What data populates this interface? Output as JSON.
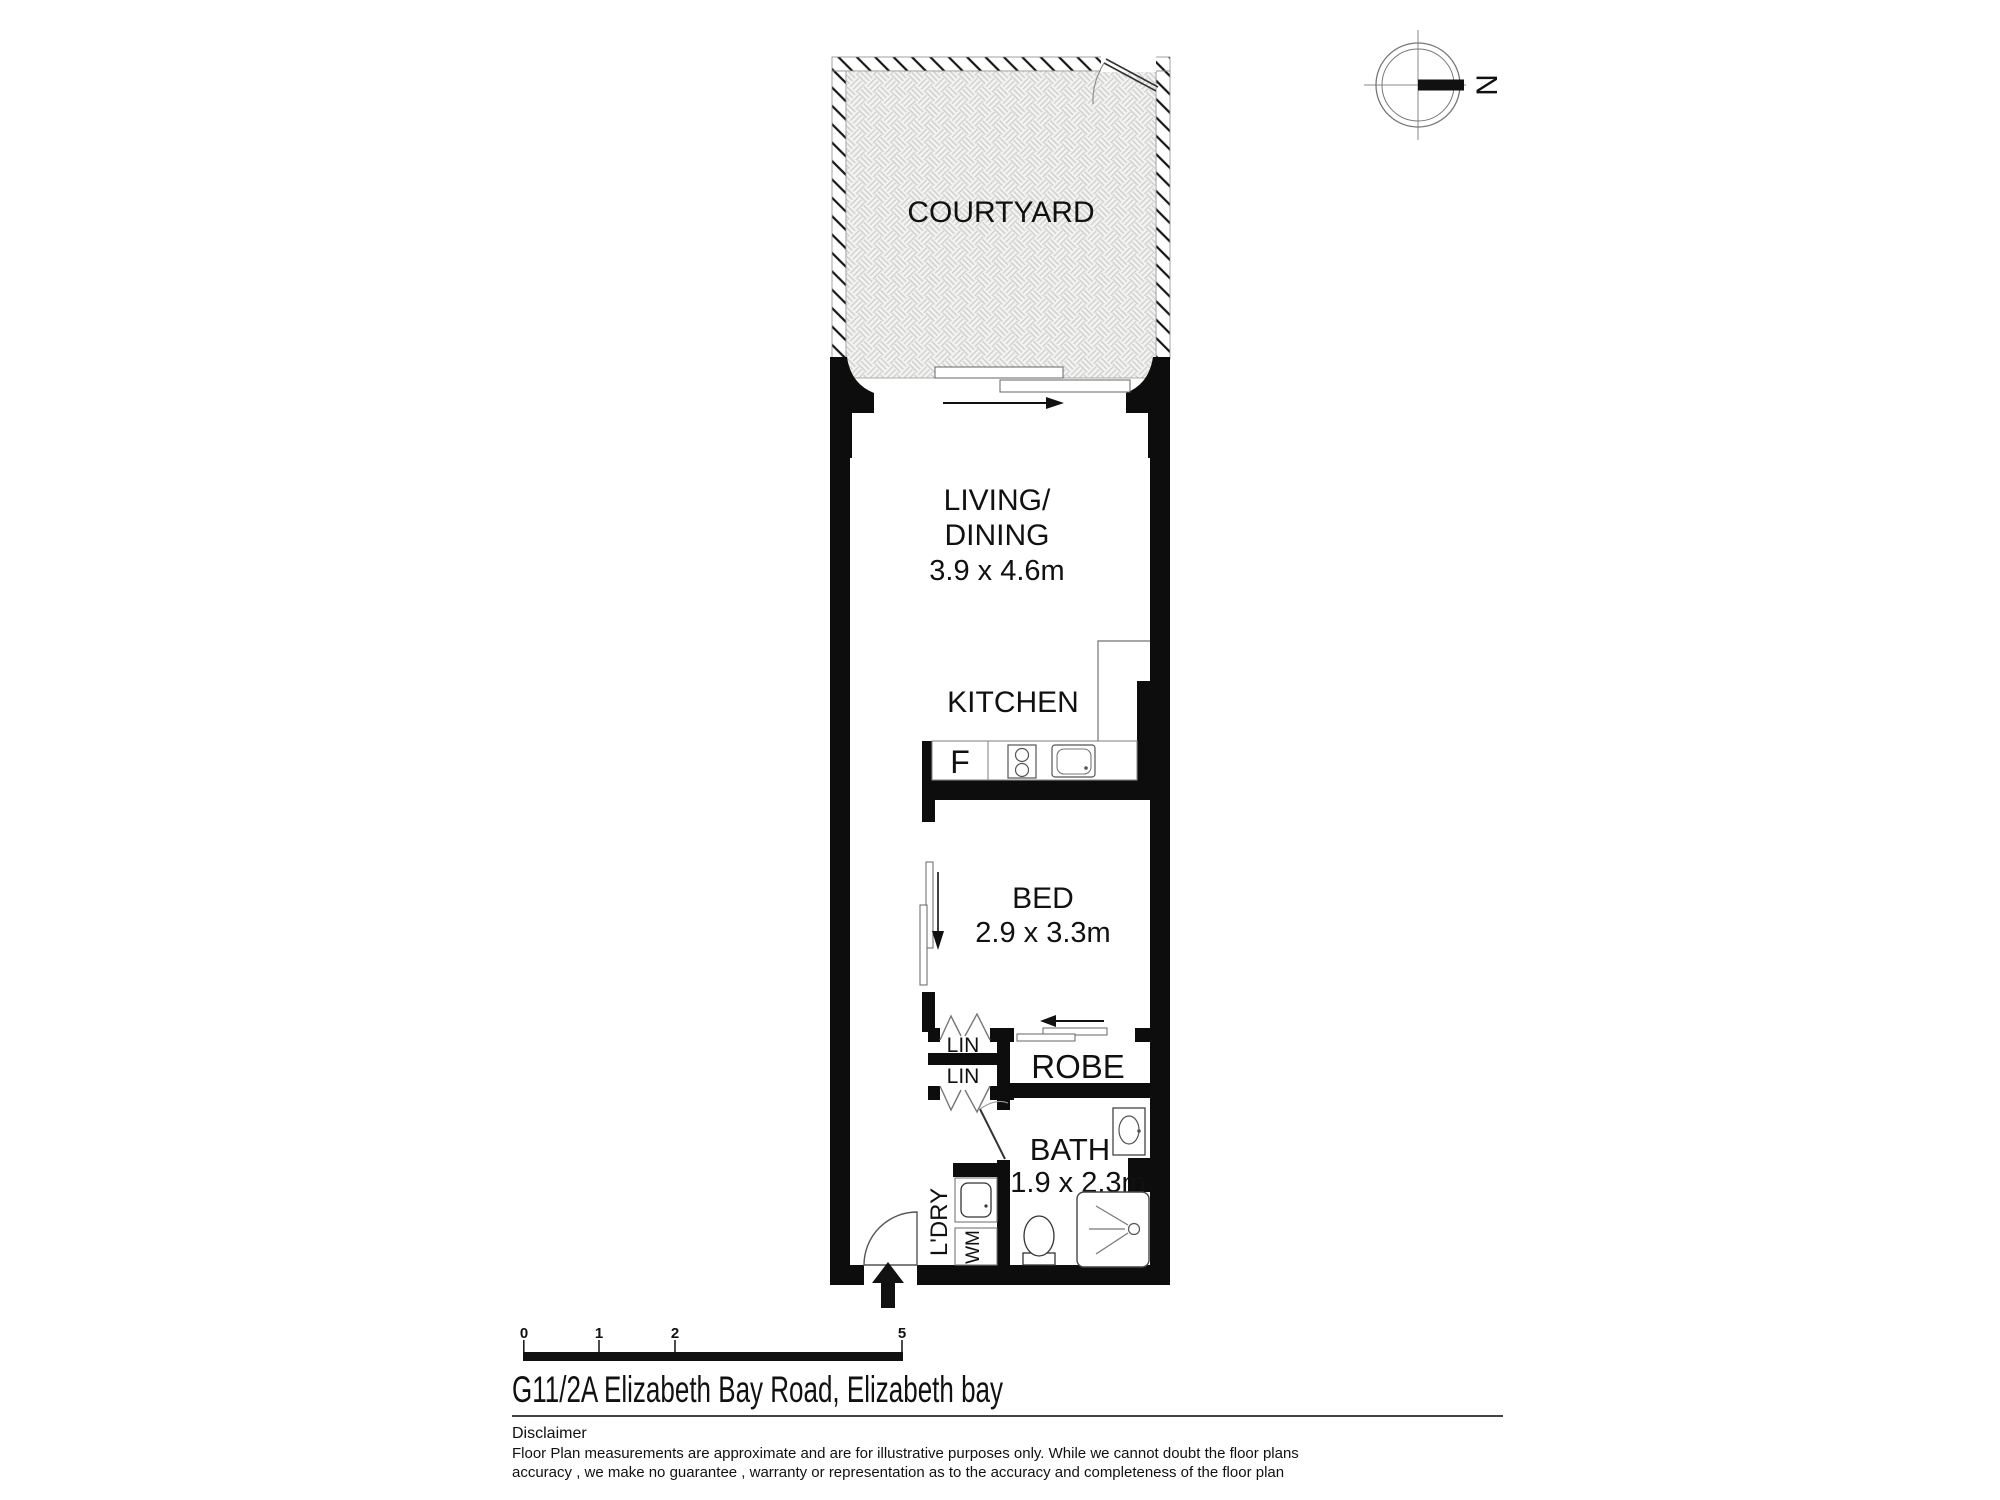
{
  "compass": {
    "north_label": "N"
  },
  "rooms": {
    "courtyard": {
      "label": "COURTYARD"
    },
    "living": {
      "label_line1": "LIVING/",
      "label_line2": "DINING",
      "dimensions": "3.9 x 4.6m"
    },
    "kitchen": {
      "label": "KITCHEN",
      "fridge_label": "F"
    },
    "bed": {
      "label": "BED",
      "dimensions": "2.9 x 3.3m"
    },
    "linen_top": {
      "label": "LIN"
    },
    "linen_bottom": {
      "label": "LIN"
    },
    "robe": {
      "label": "ROBE"
    },
    "bath": {
      "label": "BATH",
      "dimensions": "1.9 x 2.3m"
    },
    "laundry": {
      "label": "L'DRY",
      "washing_machine_label": "WM"
    }
  },
  "scale_bar": {
    "ticks": [
      "0",
      "1",
      "2",
      "5"
    ]
  },
  "footer": {
    "title": "G11/2A Elizabeth Bay Road, Elizabeth bay",
    "disclaimer_heading": "Disclaimer",
    "disclaimer_line1": "Floor Plan measurements are approximate and are for illustrative purposes only. While we cannot doubt the floor plans",
    "disclaimer_line2": "accuracy , we make no guarantee , warranty or representation as to the accuracy and completeness of the floor plan"
  },
  "colors": {
    "wall": "#0d0d0d",
    "fixture_stroke": "#444444",
    "pattern_line": "#cfcfcd",
    "courtyard_fill": "#f4f4f3"
  }
}
